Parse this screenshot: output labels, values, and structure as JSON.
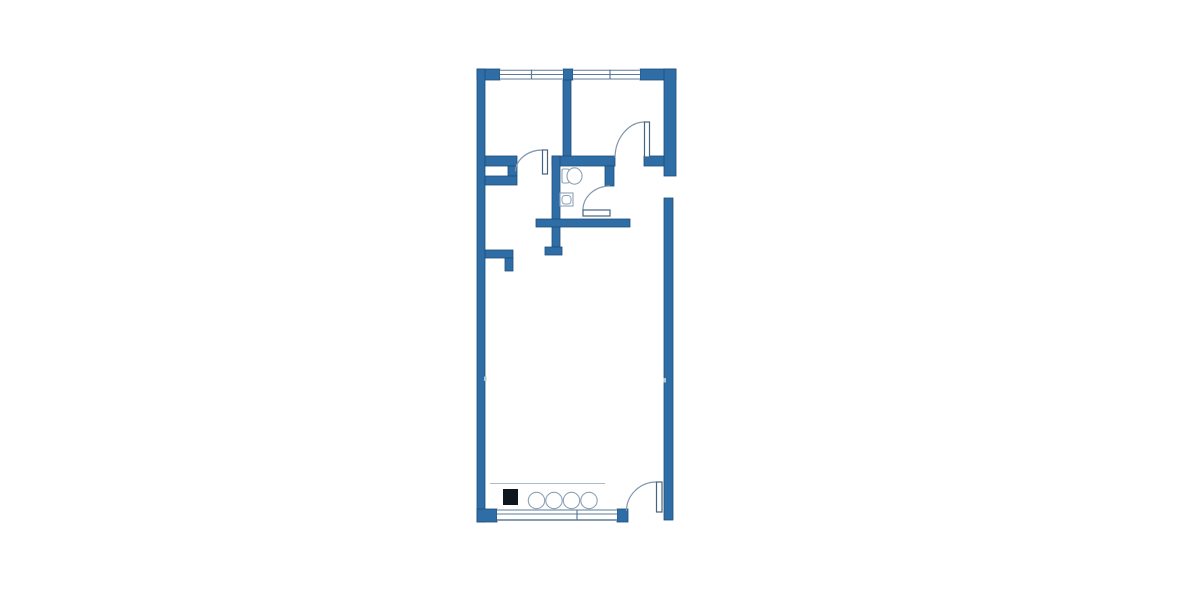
{
  "colors": {
    "wall": "#2e6da6",
    "wallEdge": "#1e4e7a",
    "winline": "#5d7b97",
    "arc": "#8196ac",
    "leaf": "#45647f",
    "fix": "#8ba1b6",
    "light": "#a9bccd",
    "tick": "#b9c6d2",
    "black": "#0e161e",
    "white": "#ffffff"
  },
  "floorplan": {
    "type": "apartment-floor-plan",
    "canvas": {
      "width": 1200,
      "height": 600
    },
    "shapes": [
      {
        "el": "rect",
        "name": "top-wall-left-block",
        "attrs": {
          "x": 477,
          "y": 69,
          "width": 23,
          "height": 11,
          "fill": "@wall",
          "stroke": "@wallEdge",
          "stroke-width": 0.8
        }
      },
      {
        "el": "rect",
        "name": "top-wall-mid-block",
        "attrs": {
          "x": 563,
          "y": 69,
          "width": 10,
          "height": 11,
          "fill": "@wall",
          "stroke": "@wallEdge",
          "stroke-width": 0.8
        }
      },
      {
        "el": "rect",
        "name": "top-wall-right-block",
        "attrs": {
          "x": 640,
          "y": 69,
          "width": 36,
          "height": 11,
          "fill": "@wall",
          "stroke": "@wallEdge",
          "stroke-width": 0.8
        }
      },
      {
        "el": "rect",
        "name": "left-exterior-wall",
        "attrs": {
          "x": 477,
          "y": 69,
          "width": 8,
          "height": 453,
          "fill": "@wall",
          "stroke": "@wallEdge",
          "stroke-width": 0.8
        }
      },
      {
        "el": "rect",
        "name": "right-exterior-wall-upper",
        "attrs": {
          "x": 664,
          "y": 69,
          "width": 12,
          "height": 107,
          "fill": "@wall",
          "stroke": "@wallEdge",
          "stroke-width": 0.8
        }
      },
      {
        "el": "rect",
        "name": "right-exterior-wall-lower",
        "attrs": {
          "x": 664,
          "y": 198,
          "width": 9,
          "height": 322,
          "fill": "@wall",
          "stroke": "@wallEdge",
          "stroke-width": 0.8
        }
      },
      {
        "el": "rect",
        "name": "bedroom-divider-wall",
        "attrs": {
          "x": 563,
          "y": 80,
          "width": 8,
          "height": 77,
          "fill": "@wall",
          "stroke": "@wallEdge",
          "stroke-width": 0.8
        }
      },
      {
        "el": "rect",
        "name": "hall-north-wall-left-segment",
        "attrs": {
          "x": 485,
          "y": 156,
          "width": 32,
          "height": 10,
          "fill": "@wall",
          "stroke": "@wallEdge",
          "stroke-width": 0.8
        }
      },
      {
        "el": "rect",
        "name": "bathroom-north-wall",
        "attrs": {
          "x": 552,
          "y": 156,
          "width": 63,
          "height": 10,
          "fill": "@wall",
          "stroke": "@wallEdge",
          "stroke-width": 0.8
        }
      },
      {
        "el": "rect",
        "name": "bedroom2-south-wall-stub",
        "attrs": {
          "x": 644,
          "y": 156,
          "width": 20,
          "height": 10,
          "fill": "@wall",
          "stroke": "@wallEdge",
          "stroke-width": 0.8
        }
      },
      {
        "el": "rect",
        "name": "shaft-east-stub",
        "attrs": {
          "x": 508,
          "y": 166,
          "width": 9,
          "height": 10,
          "fill": "@wall",
          "stroke": "@wallEdge",
          "stroke-width": 0.8
        }
      },
      {
        "el": "rect",
        "name": "shaft-south-wall",
        "attrs": {
          "x": 485,
          "y": 176,
          "width": 32,
          "height": 9,
          "fill": "@wall",
          "stroke": "@wallEdge",
          "stroke-width": 0.8
        }
      },
      {
        "el": "rect",
        "name": "hall-bathroom-wall",
        "attrs": {
          "x": 552,
          "y": 156,
          "width": 8,
          "height": 91,
          "fill": "@wall",
          "stroke": "@wallEdge",
          "stroke-width": 0.8
        }
      },
      {
        "el": "rect",
        "name": "hall-wall-end-cap",
        "attrs": {
          "x": 545,
          "y": 247,
          "width": 17,
          "height": 8,
          "fill": "@wall",
          "stroke": "@wallEdge",
          "stroke-width": 0.8
        }
      },
      {
        "el": "rect",
        "name": "bathroom-east-wall",
        "attrs": {
          "x": 605,
          "y": 166,
          "width": 9,
          "height": 20,
          "fill": "@wall",
          "stroke": "@wallEdge",
          "stroke-width": 0.8
        }
      },
      {
        "el": "rect",
        "name": "bathroom-south-wall",
        "attrs": {
          "x": 536,
          "y": 219,
          "width": 94,
          "height": 8,
          "fill": "@wall",
          "stroke": "@wallEdge",
          "stroke-width": 0.8
        }
      },
      {
        "el": "rect",
        "name": "kitchen-stub-horizontal",
        "attrs": {
          "x": 485,
          "y": 250,
          "width": 28,
          "height": 8,
          "fill": "@wall",
          "stroke": "@wallEdge",
          "stroke-width": 0.8
        }
      },
      {
        "el": "rect",
        "name": "kitchen-stub-vertical",
        "attrs": {
          "x": 505,
          "y": 258,
          "width": 8,
          "height": 13,
          "fill": "@wall",
          "stroke": "@wallEdge",
          "stroke-width": 0.8
        }
      },
      {
        "el": "rect",
        "name": "bottom-left-corner-block",
        "attrs": {
          "x": 477,
          "y": 509,
          "width": 20,
          "height": 13,
          "fill": "@wall",
          "stroke": "@wallEdge",
          "stroke-width": 0.8
        }
      },
      {
        "el": "rect",
        "name": "bottom-window-right-block",
        "attrs": {
          "x": 617,
          "y": 509,
          "width": 11,
          "height": 13,
          "fill": "@wall",
          "stroke": "@wallEdge",
          "stroke-width": 0.8
        }
      },
      {
        "el": "rect",
        "name": "top-window-1-glass",
        "attrs": {
          "x": 500,
          "y": 69,
          "width": 63,
          "height": 11,
          "fill": "@white"
        }
      },
      {
        "el": "line",
        "name": "top-window-1-outer-line",
        "attrs": {
          "x1": 500,
          "y1": 70.2,
          "x2": 563,
          "y2": 70.2,
          "stroke": "@winline",
          "stroke-width": 1
        }
      },
      {
        "el": "line",
        "name": "top-window-1-mid-line",
        "attrs": {
          "x1": 500,
          "y1": 74.5,
          "x2": 563,
          "y2": 74.5,
          "stroke": "@winline",
          "stroke-width": 1
        }
      },
      {
        "el": "line",
        "name": "top-window-1-inner-line",
        "attrs": {
          "x1": 500,
          "y1": 79,
          "x2": 563,
          "y2": 79,
          "stroke": "@winline",
          "stroke-width": 1
        }
      },
      {
        "el": "line",
        "name": "top-window-1-mullion",
        "attrs": {
          "x1": 531.5,
          "y1": 69.5,
          "x2": 531.5,
          "y2": 79.5,
          "stroke": "@winline",
          "stroke-width": 1.2
        }
      },
      {
        "el": "rect",
        "name": "top-window-2-glass",
        "attrs": {
          "x": 573,
          "y": 69,
          "width": 67,
          "height": 11,
          "fill": "@white"
        }
      },
      {
        "el": "line",
        "name": "top-window-2-outer-line",
        "attrs": {
          "x1": 573,
          "y1": 70.2,
          "x2": 640,
          "y2": 70.2,
          "stroke": "@winline",
          "stroke-width": 1
        }
      },
      {
        "el": "line",
        "name": "top-window-2-mid-line",
        "attrs": {
          "x1": 573,
          "y1": 74.5,
          "x2": 640,
          "y2": 74.5,
          "stroke": "@winline",
          "stroke-width": 1
        }
      },
      {
        "el": "line",
        "name": "top-window-2-inner-line",
        "attrs": {
          "x1": 573,
          "y1": 79,
          "x2": 640,
          "y2": 79,
          "stroke": "@winline",
          "stroke-width": 1
        }
      },
      {
        "el": "line",
        "name": "top-window-2-mullion",
        "attrs": {
          "x1": 610,
          "y1": 69.5,
          "x2": 610,
          "y2": 79.5,
          "stroke": "@winline",
          "stroke-width": 1.2
        }
      },
      {
        "el": "rect",
        "name": "bottom-window-glass",
        "attrs": {
          "x": 497,
          "y": 509,
          "width": 120,
          "height": 12,
          "fill": "@white"
        }
      },
      {
        "el": "line",
        "name": "bottom-window-inner-line",
        "attrs": {
          "x1": 497,
          "y1": 510,
          "x2": 617,
          "y2": 510,
          "stroke": "@winline",
          "stroke-width": 1
        }
      },
      {
        "el": "line",
        "name": "bottom-window-mid-line",
        "attrs": {
          "x1": 497,
          "y1": 514,
          "x2": 617,
          "y2": 514,
          "stroke": "@winline",
          "stroke-width": 1
        }
      },
      {
        "el": "line",
        "name": "bottom-window-outer-line",
        "attrs": {
          "x1": 497,
          "y1": 520,
          "x2": 617,
          "y2": 520,
          "stroke": "@winline",
          "stroke-width": 1.5
        }
      },
      {
        "el": "line",
        "name": "bottom-window-mullion",
        "attrs": {
          "x1": 577,
          "y1": 509.5,
          "x2": 577,
          "y2": 520,
          "stroke": "@winline",
          "stroke-width": 1.2
        }
      },
      {
        "el": "rect",
        "name": "left-wall-joint-tick",
        "attrs": {
          "x": 484,
          "y": 376.5,
          "width": 2.5,
          "height": 4.5,
          "fill": "@tick"
        }
      },
      {
        "el": "rect",
        "name": "right-wall-joint-tick",
        "attrs": {
          "x": 663.5,
          "y": 378,
          "width": 2.5,
          "height": 4.5,
          "fill": "@tick"
        }
      },
      {
        "el": "path",
        "name": "hall-door-arc",
        "attrs": {
          "d": "M 515.5 171.5 A 27 22 0 0 1 542.5 150",
          "fill": "none",
          "stroke": "@arc",
          "stroke-width": 1.2
        }
      },
      {
        "el": "path",
        "name": "bathroom-door-arc",
        "attrs": {
          "d": "M 583 209.5 A 27 24 0 0 1 610 186",
          "fill": "none",
          "stroke": "@arc",
          "stroke-width": 1.2
        }
      },
      {
        "el": "path",
        "name": "bedroom2-door-arc",
        "attrs": {
          "d": "M 615 157.5 A 30 36 0 0 1 644.5 122",
          "fill": "none",
          "stroke": "@arc",
          "stroke-width": 1.2
        }
      },
      {
        "el": "path",
        "name": "entry-door-arc",
        "attrs": {
          "d": "M 626.5 511 A 30 29 0 0 1 656.5 482",
          "fill": "none",
          "stroke": "@arc",
          "stroke-width": 1.2
        }
      },
      {
        "el": "rect",
        "name": "hall-door-leaf",
        "attrs": {
          "x": 542.5,
          "y": 150,
          "width": 5,
          "height": 24,
          "fill": "@white",
          "stroke": "@leaf",
          "stroke-width": 1.2
        }
      },
      {
        "el": "rect",
        "name": "bathroom-door-leaf",
        "attrs": {
          "x": 583,
          "y": 210,
          "width": 27,
          "height": 6,
          "fill": "@white",
          "stroke": "@leaf",
          "stroke-width": 1.2
        }
      },
      {
        "el": "rect",
        "name": "bedroom2-door-leaf",
        "attrs": {
          "x": 644.5,
          "y": 122,
          "width": 5,
          "height": 35,
          "fill": "@white",
          "stroke": "@leaf",
          "stroke-width": 1.2
        }
      },
      {
        "el": "rect",
        "name": "entry-door-leaf",
        "attrs": {
          "x": 656.5,
          "y": 482,
          "width": 5.5,
          "height": 30,
          "fill": "@white",
          "stroke": "@leaf",
          "stroke-width": 1.2
        }
      },
      {
        "el": "rect",
        "name": "toilet-tank",
        "attrs": {
          "x": 562,
          "y": 169,
          "width": 7,
          "height": 14,
          "rx": 1.5,
          "fill": "@white",
          "stroke": "@fix",
          "stroke-width": 1.1
        }
      },
      {
        "el": "ellipse",
        "name": "toilet-bowl",
        "attrs": {
          "cx": 574.5,
          "cy": 176,
          "rx": 7.5,
          "ry": 8.2,
          "fill": "@white",
          "stroke": "@fix",
          "stroke-width": 1.1
        }
      },
      {
        "el": "rect",
        "name": "sink-counter",
        "attrs": {
          "x": 560,
          "y": 193,
          "width": 13,
          "height": 13,
          "fill": "@white",
          "stroke": "@fix",
          "stroke-width": 1.1
        }
      },
      {
        "el": "rect",
        "name": "sink-basin",
        "attrs": {
          "x": 562,
          "y": 195.5,
          "width": 9,
          "height": 8.5,
          "rx": 3,
          "fill": "@white",
          "stroke": "@fix",
          "stroke-width": 1
        }
      },
      {
        "el": "line",
        "name": "kitchen-counter-line",
        "attrs": {
          "x1": 490,
          "y1": 483.5,
          "x2": 605,
          "y2": 483.5,
          "stroke": "@light",
          "stroke-width": 1.1
        }
      },
      {
        "el": "rect",
        "name": "kitchen-appliance-block",
        "attrs": {
          "x": 503,
          "y": 489,
          "width": 15,
          "height": 16,
          "fill": "@black"
        }
      },
      {
        "el": "circle",
        "name": "kitchen-burner-1",
        "attrs": {
          "cx": 536.5,
          "cy": 500.5,
          "r": 8.2,
          "fill": "@white",
          "stroke": "@fix",
          "stroke-width": 1.1
        }
      },
      {
        "el": "circle",
        "name": "kitchen-burner-2",
        "attrs": {
          "cx": 554,
          "cy": 500.5,
          "r": 8.2,
          "fill": "@white",
          "stroke": "@fix",
          "stroke-width": 1.1
        }
      },
      {
        "el": "circle",
        "name": "kitchen-burner-3",
        "attrs": {
          "cx": 571.5,
          "cy": 500.5,
          "r": 8.2,
          "fill": "@white",
          "stroke": "@fix",
          "stroke-width": 1.1
        }
      },
      {
        "el": "circle",
        "name": "kitchen-burner-4",
        "attrs": {
          "cx": 589,
          "cy": 500.5,
          "r": 8.2,
          "fill": "@white",
          "stroke": "@fix",
          "stroke-width": 1.1
        }
      }
    ]
  }
}
